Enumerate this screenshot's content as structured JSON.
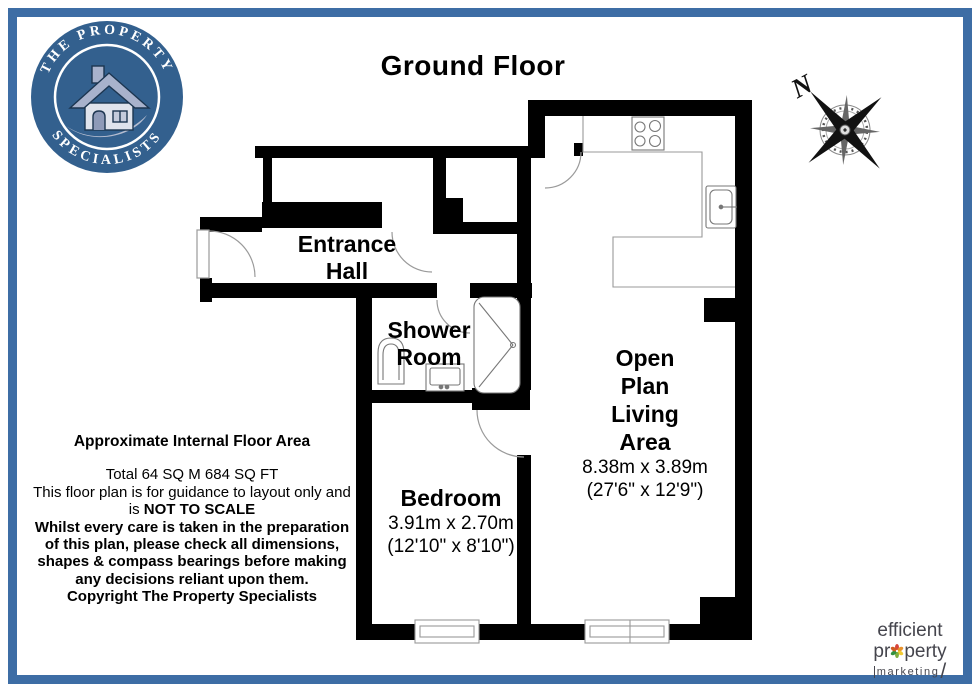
{
  "title": "Ground Floor",
  "logo": {
    "top_text": "THE PROPERTY",
    "bottom_text": "SPECIALISTS"
  },
  "compass": {
    "label": "N"
  },
  "rooms": {
    "entrance_hall": {
      "line1": "Entrance",
      "line2": "Hall"
    },
    "shower_room": {
      "line1": "Shower",
      "line2": "Room"
    },
    "bedroom": {
      "name": "Bedroom",
      "dims_metric": "3.91m x 2.70m",
      "dims_imperial": "(12'10\" x 8'10\")"
    },
    "living": {
      "name_lines": [
        "Open",
        "Plan",
        "Living",
        "Area"
      ],
      "dims_metric": "8.38m x 3.89m",
      "dims_imperial": "(27'6\" x 12'9\")"
    }
  },
  "disclaimer": {
    "heading": "Approximate Internal Floor Area",
    "line_total": "Total 64 SQ M 684 SQ FT",
    "line_guidance": "This floor plan is for guidance to layout only and",
    "not_to_scale_prefix": "is ",
    "not_to_scale": "NOT TO SCALE",
    "bold_lines": [
      "Whilst every care is taken in the preparation",
      "of this plan, please check all dimensions,",
      "shapes & compass bearings before making",
      "any decisions reliant upon them.",
      "Copyright The Property Specialists"
    ]
  },
  "footer_logo": {
    "line1": "efficient",
    "line2_prefix": "pr",
    "line2_suffix": "perty",
    "line3": "marketing",
    "slash": "/"
  },
  "colors": {
    "border_blue": "#3d6da5",
    "logo_disc_blue": "#33608e",
    "wall_black": "#000000",
    "footer_text": "#45454d",
    "pinwheel": [
      "#d8453b",
      "#e8932d",
      "#f2cb32",
      "#7fae3e",
      "#33913f",
      "#cf5c22"
    ]
  }
}
